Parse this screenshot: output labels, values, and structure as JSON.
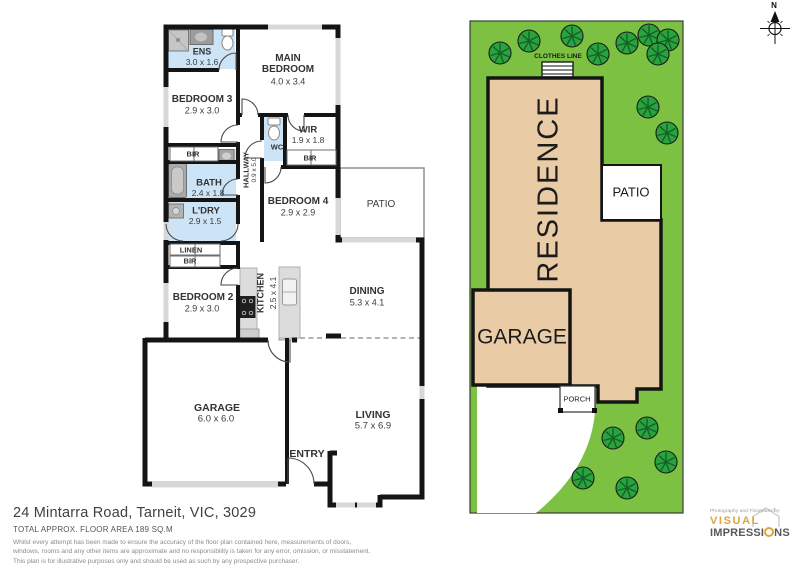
{
  "colors": {
    "wall": "#141414",
    "wet_area": "#cde4f6",
    "grass": "#7cc141",
    "tree": "#2aa23d",
    "residence_fill": "#e9cba6",
    "logo_orange": "#dfa43e",
    "logo_gray": "#58585a"
  },
  "floor_plan": {
    "ens": {
      "name": "ENS",
      "dims": "3.0 x 1.6"
    },
    "main_bedroom": {
      "line1": "MAIN",
      "line2": "BEDROOM",
      "dims": "4.0 x 3.4"
    },
    "bedroom3": {
      "name": "BEDROOM 3",
      "dims": "2.9 x 3.0"
    },
    "wir": {
      "name": "WIR",
      "dims": "1.9 x 1.8"
    },
    "wc": {
      "name": "WC"
    },
    "bir_bed3": {
      "name": "BIR"
    },
    "bir_wir": {
      "name": "BIR"
    },
    "bir_bed2": {
      "name": "BIR"
    },
    "linen": {
      "name": "LINEN"
    },
    "bath": {
      "name": "BATH",
      "dims": "2.4 x 1.8"
    },
    "hallway": {
      "name": "HALLWAY",
      "dims": "0.9 x 5.0"
    },
    "laundry": {
      "name": "L'DRY",
      "dims": "2.9 x 1.5"
    },
    "bedroom4": {
      "name": "BEDROOM 4",
      "dims": "2.9 x 2.9"
    },
    "patio": {
      "name": "PATIO"
    },
    "bedroom2": {
      "name": "BEDROOM 2",
      "dims": "2.9 x 3.0"
    },
    "kitchen": {
      "name": "KITCHEN",
      "dims": "2.5 x 4.1"
    },
    "dining": {
      "name": "DINING",
      "dims": "5.3 x 4.1"
    },
    "garage": {
      "name": "GARAGE",
      "dims": "6.0 x 6.0"
    },
    "living": {
      "name": "LIVING",
      "dims": "5.7 x 6.9"
    },
    "entry": {
      "name": "ENTRY"
    }
  },
  "site_plan": {
    "residence": "RESIDENCE",
    "garage": "GARAGE",
    "patio": "PATIO",
    "porch": "PORCH",
    "clothes_line": "CLOTHES LINE",
    "north": "N"
  },
  "footer": {
    "address": "24 Mintarra Road, Tarneit, VIC, 3029",
    "area": "TOTAL APPROX. FLOOR AREA 189 SQ.M",
    "disclaimer": [
      "Whilst every attempt has been made to ensure the accuracy of the floor plan contained here, measurements of doors,",
      "windows, rooms and any other items are approximate and no responsibility is taken for any error, omission, or misstatement.",
      "This plan is for illustrative purposes only and should be used as such by any prospective purchaser."
    ]
  },
  "logo": {
    "tagline": "Photography and Floorplans by",
    "name_line1": "VISUAL",
    "name_line2_a": "IMPRESSI",
    "name_line2_b": "NS"
  }
}
